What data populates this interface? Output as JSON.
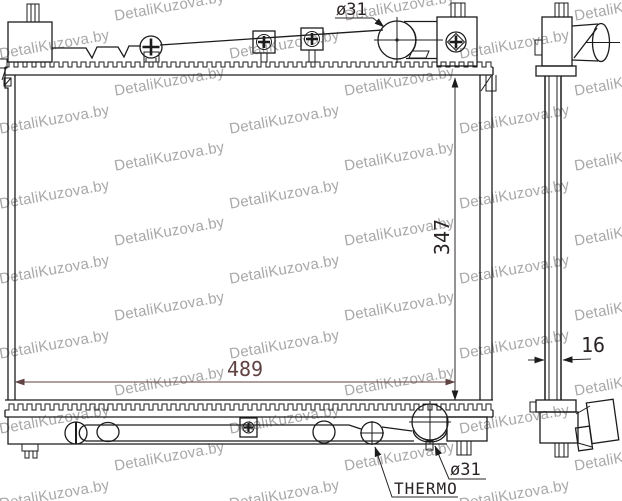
{
  "watermark": {
    "text": "DetaliKuzova.by",
    "color": "#a9a7a7"
  },
  "labels": {
    "dim_width": "489",
    "dim_height": "347",
    "dim_thickness": "16",
    "dia_top": "ø31",
    "dia_bottom": "ø31",
    "thermo": "THERMO"
  },
  "colors": {
    "line": "#1c1c1c",
    "dim": "#2b2424",
    "dim_accent": "#5f4242"
  }
}
